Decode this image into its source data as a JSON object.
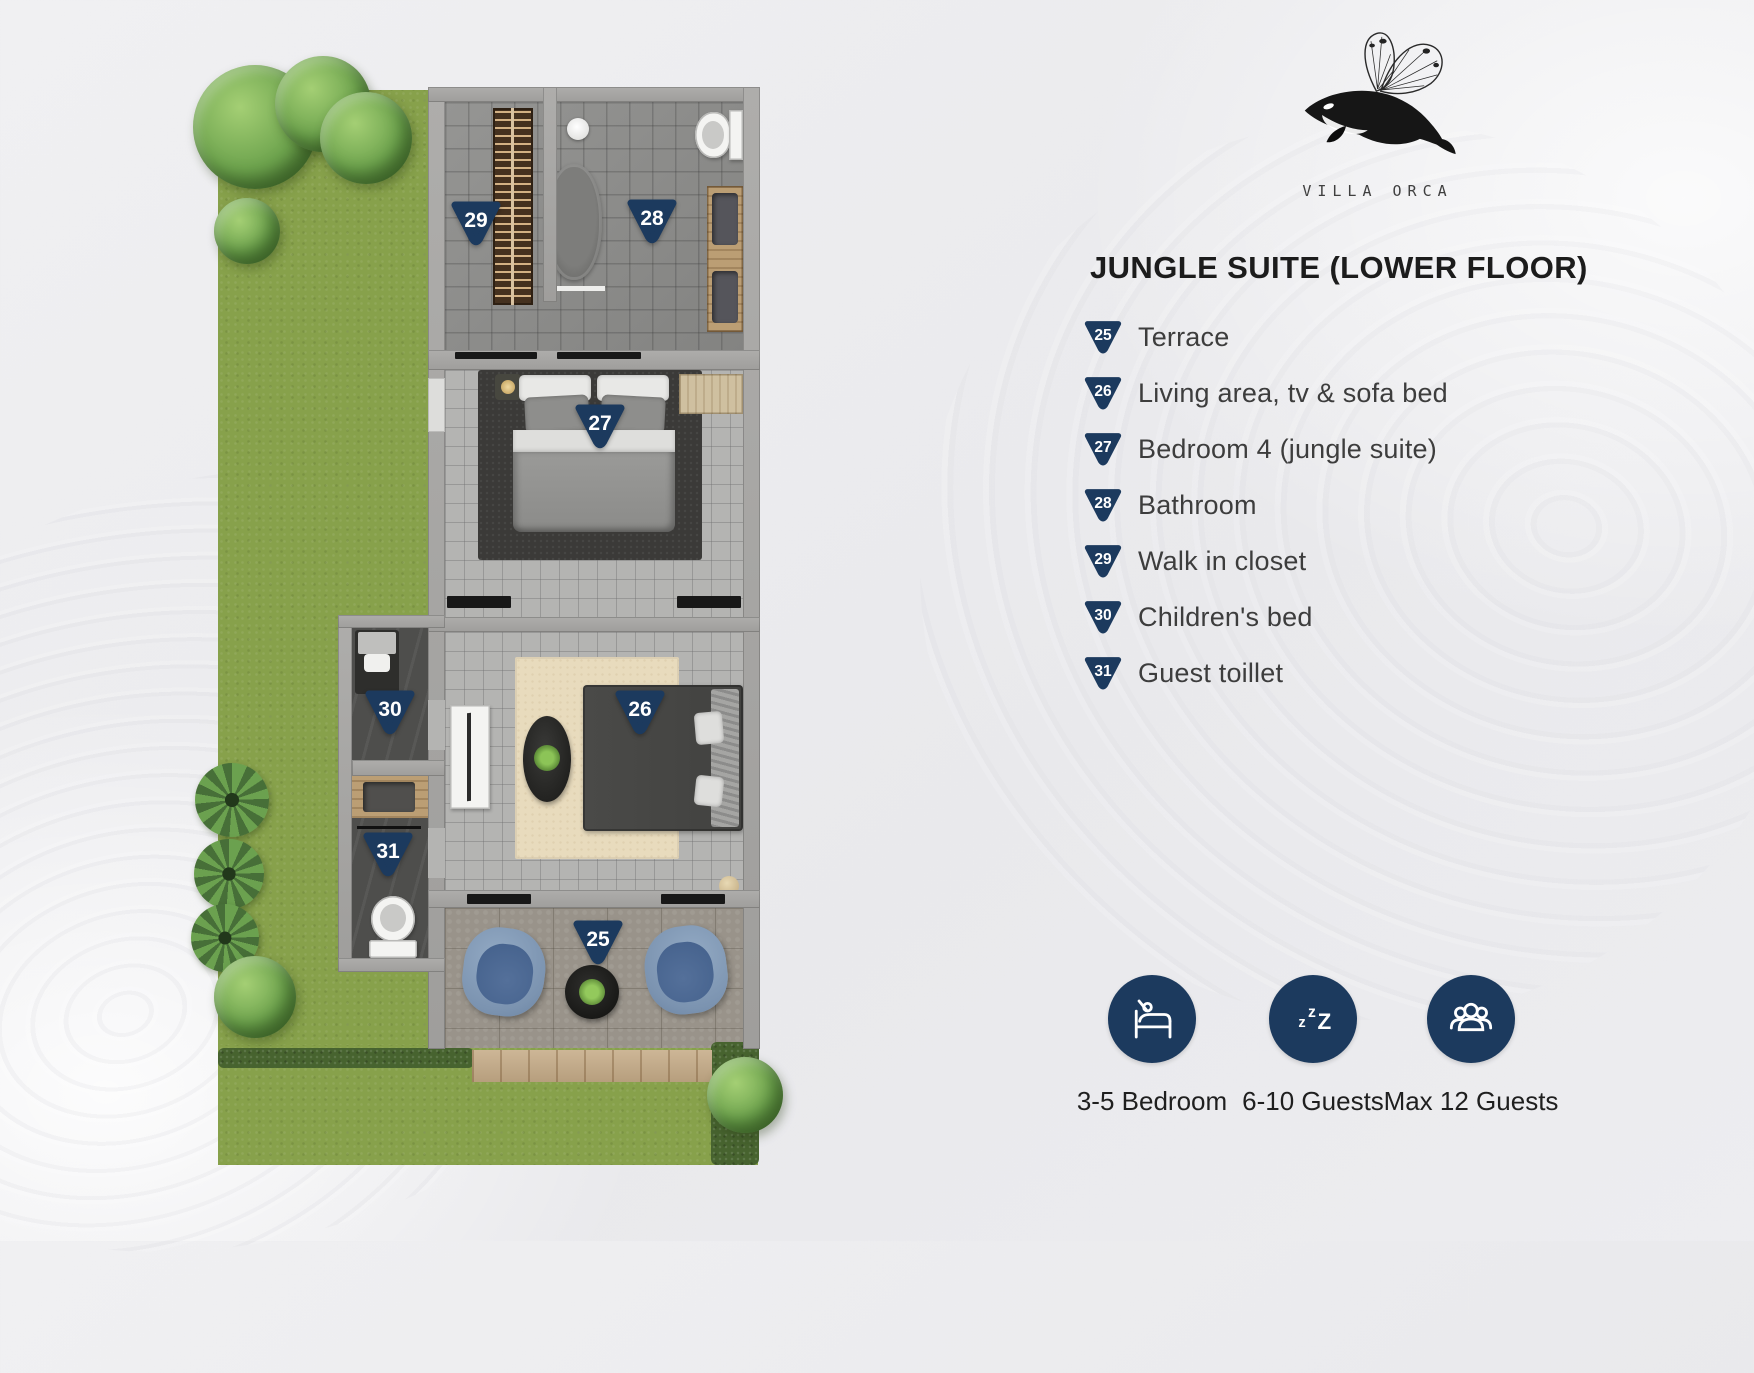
{
  "brand": {
    "name": "VILLA ORCA",
    "logo": "orca-butterfly-logo"
  },
  "title": "JUNGLE SUITE (LOWER FLOOR)",
  "legend": [
    {
      "num": "25",
      "label": "Terrace"
    },
    {
      "num": "26",
      "label": "Living area, tv & sofa bed"
    },
    {
      "num": "27",
      "label": "Bedroom 4 (jungle suite)"
    },
    {
      "num": "28",
      "label": "Bathroom"
    },
    {
      "num": "29",
      "label": "Walk in closet"
    },
    {
      "num": "30",
      "label": "Children's bed"
    },
    {
      "num": "31",
      "label": "Guest toillet"
    }
  ],
  "stats": [
    {
      "icon": "bed-icon",
      "label": "3-5 Bedroom"
    },
    {
      "icon": "sleep-zzz-icon",
      "label": "6-10 Guests"
    },
    {
      "icon": "guests-group-icon",
      "label": "Max 12 Guests"
    }
  ],
  "colors": {
    "navy": "#1c3a5e",
    "grass": "#87a14b",
    "title_text": "#1c1c1c",
    "legend_text": "#3d3d3d"
  }
}
